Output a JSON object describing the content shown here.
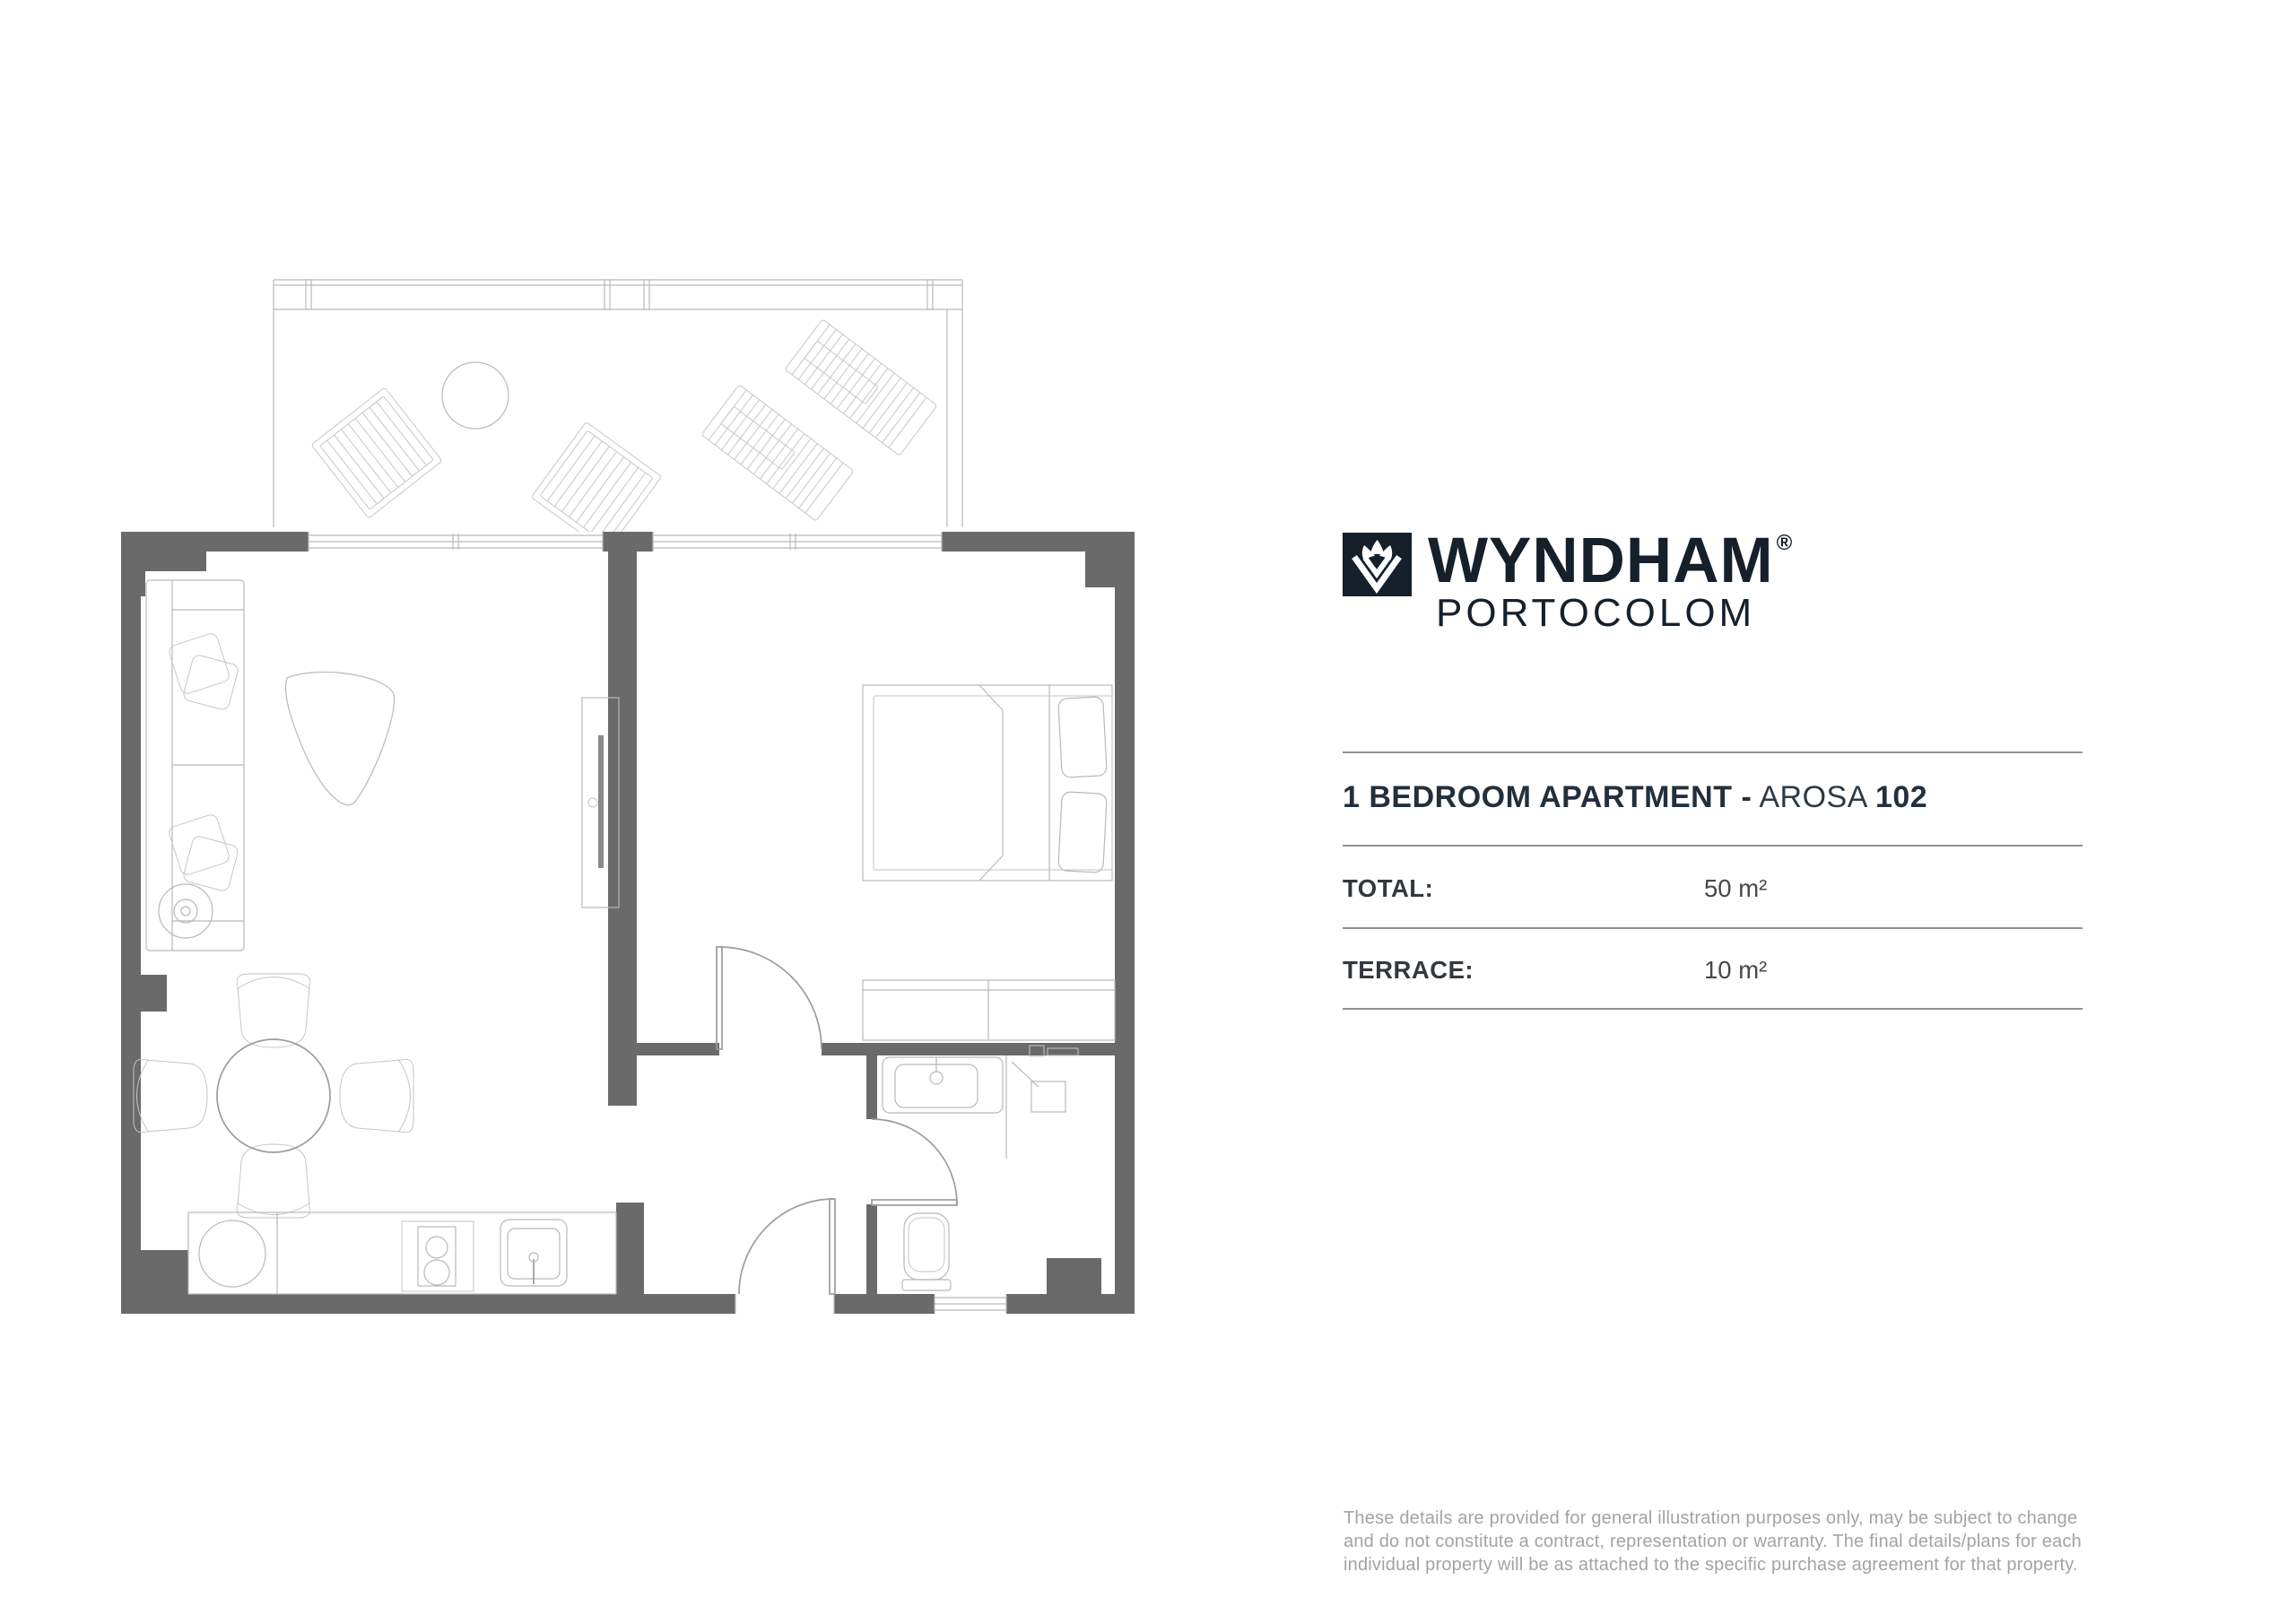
{
  "brand": {
    "wordmark": "WYNDHAM",
    "registered_mark": "®",
    "subtitle": "PORTOCOLOM",
    "logo_square_color": "#15202b",
    "text_color": "#1a2532"
  },
  "listing": {
    "title": {
      "bold_lead": "1 BEDROOM APARTMENT -",
      "name_regular": "AROSA",
      "unit_bold": "102"
    },
    "specs": [
      {
        "label": "TOTAL:",
        "value": "50 m²"
      },
      {
        "label": "TERRACE:",
        "value": "10 m²"
      }
    ],
    "disclaimer": "These details are provided for general illustration purposes only, may be subject to change and do not constitute a contract, representation or warranty. The final details/plans for each individual property will be as attached to the specific purchase agreement for that property."
  },
  "floorplan": {
    "wall_color": "#6a6a6a",
    "outline_color": "#9c9c9c",
    "furniture_line_color": "#b9b9b9"
  }
}
